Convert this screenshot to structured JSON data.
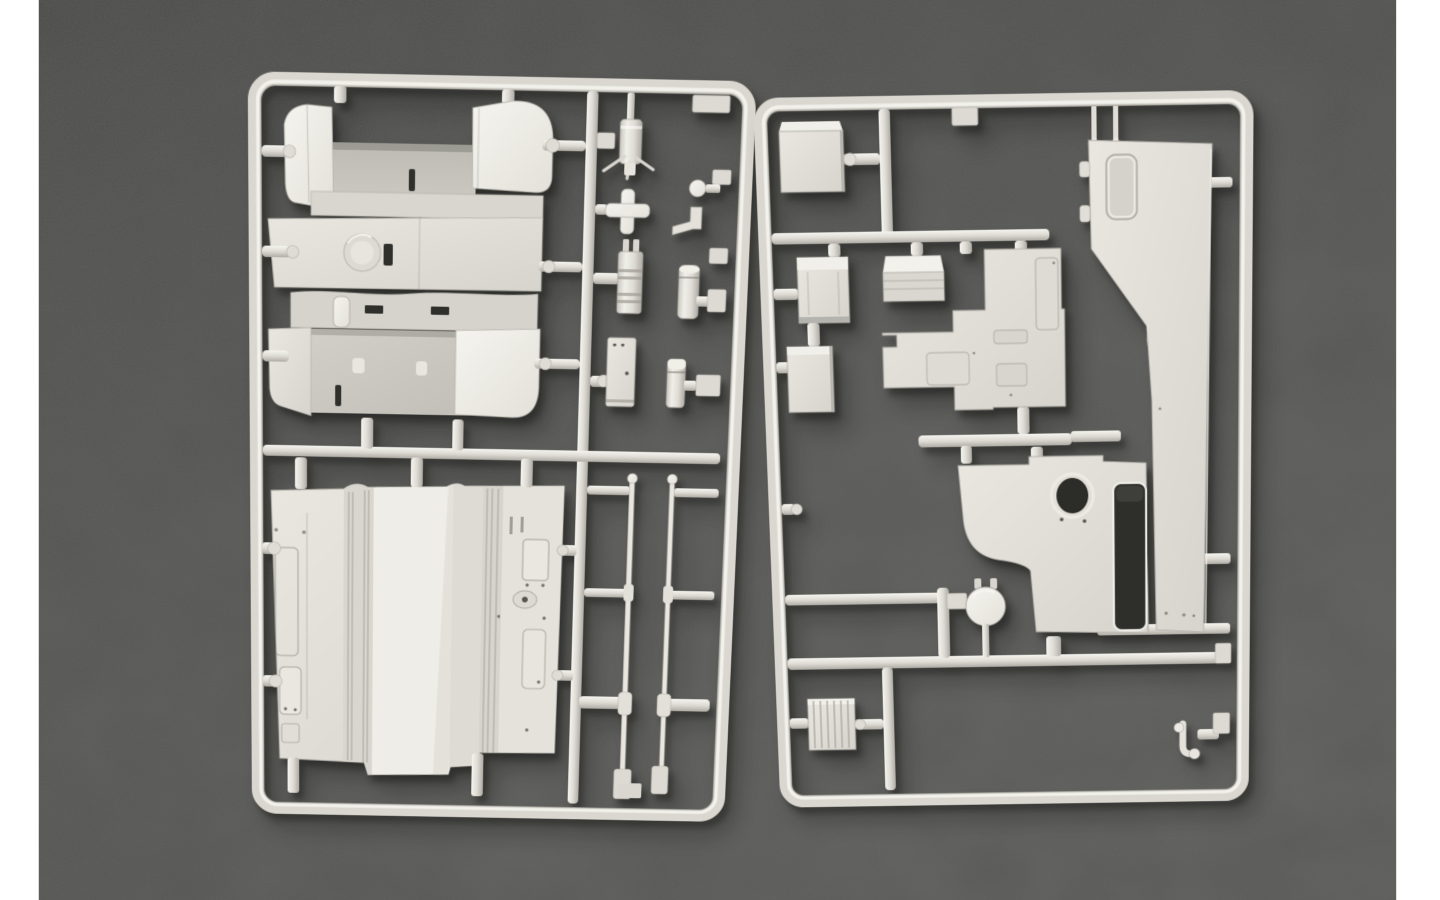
{
  "scene": {
    "title": "Model kit sprues photograph",
    "description": "Top-down product photo of two ivory injection-moulded plastic sprues (model-kit part trees) of a military truck kit lying on dark grey felt, with white page margins on the left and right edges.",
    "colors": {
      "page": "#ffffff",
      "felt-a": "#4f4f4e",
      "felt-b": "#5a5a59",
      "felt-c": "#666665",
      "felt-d": "#6e6e6c",
      "plastic": "#e0ded6",
      "plastic-bright": "#f3f2ed",
      "plastic-shade": "#b4b2aa",
      "plastic-deep": "#9a988f",
      "slot": "#2f2f2b"
    }
  },
  "sprue_left": {
    "aria": "Left sprue: truck cab shell, ribbed cargo-bed floor panel, nozzle, cross coupling, connector plug, canisters, junction box and two long antenna rods held in a rectangular runner frame",
    "parts": [
      {
        "id": "frame",
        "label": "Rectangular runner frame with rounded corners"
      },
      {
        "id": "cab-shell",
        "label": "Truck cab shell with folded side panels, roof hatch ring and vent slots"
      },
      {
        "id": "bed-floor",
        "label": "Cargo-bed floor panel with ribbed channels, door outlines and hatch plates"
      },
      {
        "id": "nozzle",
        "label": "Grease-gun nozzle with moulding gates"
      },
      {
        "id": "cross-coupling",
        "label": "Cross-shaped coupling"
      },
      {
        "id": "plug-block",
        "label": "Two-prong ribbed connector block"
      },
      {
        "id": "canister-tall",
        "label": "Tall cylindrical canister"
      },
      {
        "id": "junction-box",
        "label": "Rectangular junction box"
      },
      {
        "id": "canister-short",
        "label": "Short cylindrical canister with domed cap"
      },
      {
        "id": "elbow-fitting",
        "label": "L-shaped elbow fitting and round knob"
      },
      {
        "id": "rod-left",
        "label": "Long antenna rod with ball tip and moulded collars"
      },
      {
        "id": "rod-right",
        "label": "Long antenna rod with ball tip and moulded collars"
      }
    ]
  },
  "sprue_right": {
    "aria": "Right sprue: stowage boxes, stepped engine-deck panel, tall cab side panel with window, bulkhead panel with round port and large opening, spherical valve, ribbed crate and towing hook held in a rectangular runner frame",
    "parts": [
      {
        "id": "frame",
        "label": "Rectangular runner frame with rounded corners"
      },
      {
        "id": "stowage-box",
        "label": "Square stowage box"
      },
      {
        "id": "top-tab",
        "label": "Flat mounting tab"
      },
      {
        "id": "ribbed-box",
        "label": "Tall ribbed stowage box"
      },
      {
        "id": "wide-box",
        "label": "Wide stowage box with lid"
      },
      {
        "id": "small-box",
        "label": "Small stowage box"
      },
      {
        "id": "stepped-panel",
        "label": "Stepped engine-deck panel with recessed access plates"
      },
      {
        "id": "side-panel",
        "label": "Tall cab side panel with recessed window and hinge pegs"
      },
      {
        "id": "bulkhead",
        "label": "Bulkhead panel with round port and large rounded rectangular opening"
      },
      {
        "id": "ball-valve",
        "label": "Spherical valve fitting with twin prongs"
      },
      {
        "id": "ribbed-crate",
        "label": "Ribbed crate block"
      },
      {
        "id": "tow-hook",
        "label": "Small J-shaped towing hook"
      }
    ]
  }
}
